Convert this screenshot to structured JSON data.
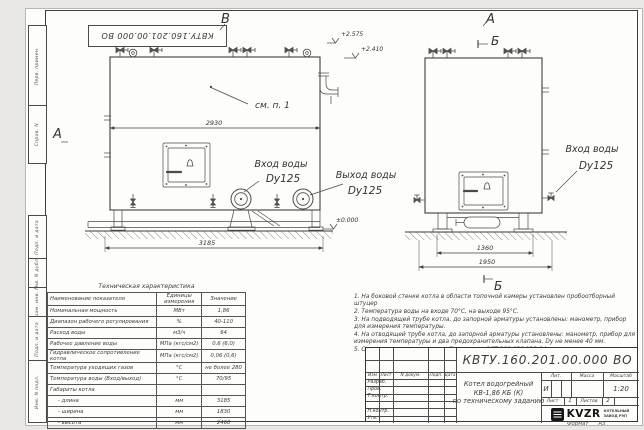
{
  "page": {
    "format_label": "Формат",
    "format_value": "А3"
  },
  "frame": {
    "top_stamp": "КВТУ.160.201.00.000 ВО",
    "left_labels": [
      "Перв. примен.",
      "Справ. N",
      "Подп. и дата",
      "Инв. N дубл.",
      "Взам. инв. N",
      "Подп. и дата",
      "Инв. N подл."
    ]
  },
  "drawing": {
    "front": {
      "arrow_label": "В",
      "section_label_left": "А",
      "note_ref": "см. п. 1",
      "dim_body": "2930",
      "dim_total": "3185",
      "elev_top": "+2.575",
      "elev_valve": "+2.410",
      "elev_zero": "±0.000",
      "inlet_title": "Вход воды",
      "inlet_size": "Dy125",
      "outlet_title": "Выход воды",
      "outlet_size": "Dy125"
    },
    "side": {
      "arrow_label": "А",
      "section_label": "Б",
      "dim_inner": "1360",
      "dim_outer": "1950",
      "inlet_title": "Вход воды",
      "inlet_size": "Dy125"
    }
  },
  "spec_table": {
    "title": "Техническая характеристика",
    "headers": [
      "Наименование показателя",
      "Единицы измерения",
      "Значение"
    ],
    "rows": [
      [
        "Номинальная мощность",
        "МВт",
        "1,86"
      ],
      [
        "Диапазон рабочего регулирования",
        "%",
        "40-110"
      ],
      [
        "Расход воды",
        "м3/ч",
        "64"
      ],
      [
        "Рабочее давление воды",
        "МПа (кгс/см2)",
        "0,6 (6,0)"
      ],
      [
        "Гидравлическое сопротивление котла",
        "МПа (кгс/см2)",
        "0,06 (0,6)"
      ],
      [
        "Температура уходящих газов",
        "°С",
        "не более 280"
      ],
      [
        "Температура воды (Вход/выход)",
        "°С",
        "70/95"
      ],
      [
        "Габариты котла",
        "",
        ""
      ],
      [
        "- длина",
        "мм",
        "3185"
      ],
      [
        "- ширина",
        "мм",
        "1830"
      ],
      [
        "- высота",
        "мм",
        "2460"
      ]
    ]
  },
  "notes": [
    "1.  На боковой стенке котла в области топочной камеры установлен пробоотборный штуцер",
    "2.  Температура воды на входе 70°С, на выходе 95°С.",
    "3.  На подводящей трубе котла, до запорной арматуры установлены: манометр, прибор для измерения температуры.",
    "4.  На отводящей трубе котла, до запорной арматуры установлены: манометр, прибор для измерения температуры и два предохранительных клапана. Dу не менее 40 мм.",
    "5.  Остальные технические требования по ОСТ 108.030.133-84."
  ],
  "title_block": {
    "doc_number": "КВТУ.160.201.00.000 ВО",
    "product_line1": "Котел водогрейный",
    "product_line2": "КВ-1,86 КБ (К)",
    "product_line3": "по техническому заданию",
    "header_cols": [
      "Изм",
      "Лист",
      "N докум.",
      "Подп.",
      "Дата"
    ],
    "row_labels": [
      "Разраб.",
      "Пров.",
      "Т.контр.",
      "",
      "Н.контр.",
      "Утв."
    ],
    "lit_label": "Лит.",
    "lit_value": "И",
    "mass_label": "Масса",
    "scale_label": "Масштаб",
    "scale_value": "1:20",
    "sheet_label": "Лист",
    "sheet_value": "1",
    "sheets_label": "Листов",
    "sheets_value": "2",
    "brand": "KVZR",
    "brand_line1": "КОТЕЛЬНЫЙ",
    "brand_line2": "ЗАВОД РЭП"
  }
}
